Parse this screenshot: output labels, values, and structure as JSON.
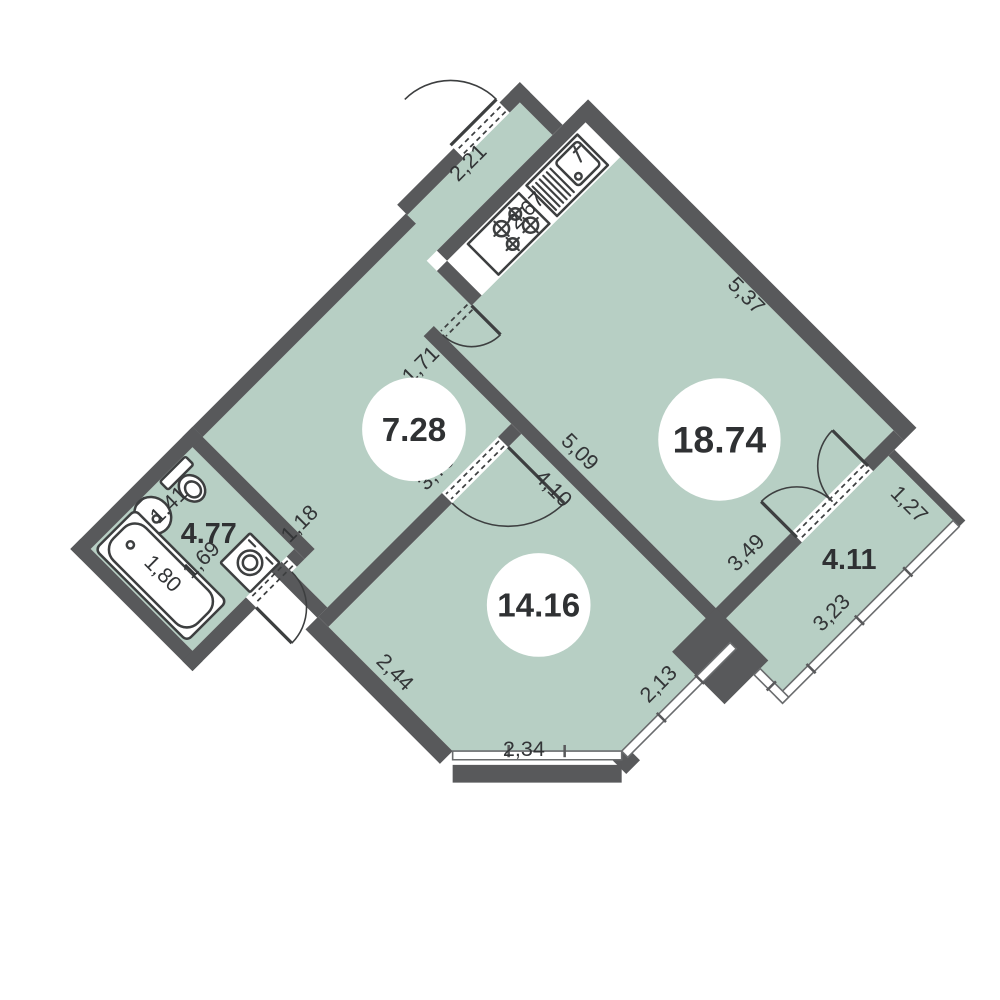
{
  "floorplan": {
    "units": "m",
    "rooms": [
      {
        "id": "living-room",
        "area_label": "18.74"
      },
      {
        "id": "hall-kitchen",
        "area_label": "7.28"
      },
      {
        "id": "bathroom",
        "area_label": "4.77"
      },
      {
        "id": "bedroom",
        "area_label": "14.16"
      },
      {
        "id": "balcony",
        "area_label": "4.11"
      }
    ],
    "dimensions": {
      "kitchen_niche": "2,67",
      "living_top": "5,37",
      "entrance_wall": "2,21",
      "hall_kitchen_wall": "1,71",
      "living_bottom": "5,09",
      "bedroom_top": "4,10",
      "bedroom_left": "3,79",
      "bath_door_wall": "1,18",
      "bath_left_zone": "1,41",
      "bath_right_zone": "1,69",
      "bathtub_length": "1,80",
      "balcony_door_wall": "3,49",
      "balcony_top": "1,27",
      "balcony_right": "3,23",
      "bedroom_right": "2,13",
      "bedroom_chamfer": "2,34",
      "bedroom_bottom": "2,44"
    },
    "fixtures": [
      "kitchen-sink",
      "stove",
      "toilet",
      "washbasin",
      "bathtub",
      "washing-machine"
    ],
    "colors": {
      "wall": "#58595b",
      "room_fill": "#b7cfc4",
      "background": "#ffffff",
      "line": "#3d3f40",
      "text": "#2f3133"
    }
  }
}
